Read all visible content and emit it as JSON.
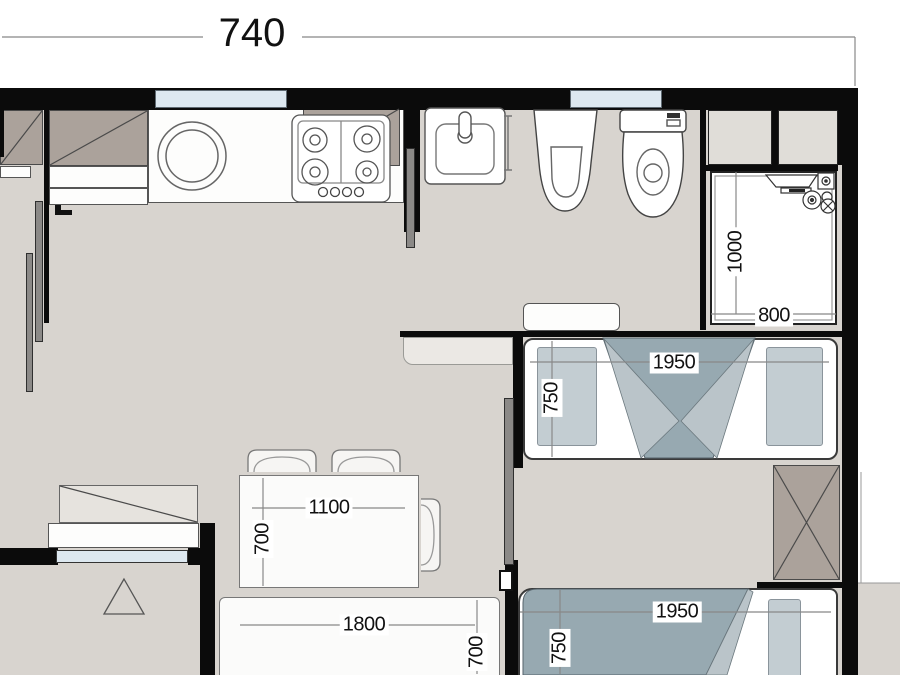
{
  "plan": {
    "overall_dimension": "740",
    "labels": {
      "shower_depth": "1000",
      "shower_width": "800",
      "bed1_length": "1950",
      "bed1_width": "750",
      "bed2_length": "1950",
      "bed2_width": "750",
      "table_length": "1100",
      "table_width": "700",
      "sofa_length": "1800",
      "sofa_width": "700"
    },
    "fixtures": [
      "washing-machine",
      "cooktop",
      "kitchen-upper-cabinet",
      "wash-basin",
      "towel-rail",
      "bidet",
      "toilet",
      "shower-stall",
      "duct-shaft",
      "night-shelf",
      "double-bed",
      "single-bed",
      "wardrobe-x",
      "dining-table",
      "chair",
      "sofa-bed",
      "sliding-door",
      "balcony-triangle",
      "window"
    ],
    "colors": {
      "wall": "#0b0b0b",
      "floor": "#d8d4cf",
      "window_glass": "#dde8f0",
      "cabinet": "#aba29b",
      "blanket_dark": "#97a9b1",
      "blanket_light": "#bac4c9",
      "pillow": "#c3cdd2",
      "sliding_door": "#8b8987"
    }
  }
}
